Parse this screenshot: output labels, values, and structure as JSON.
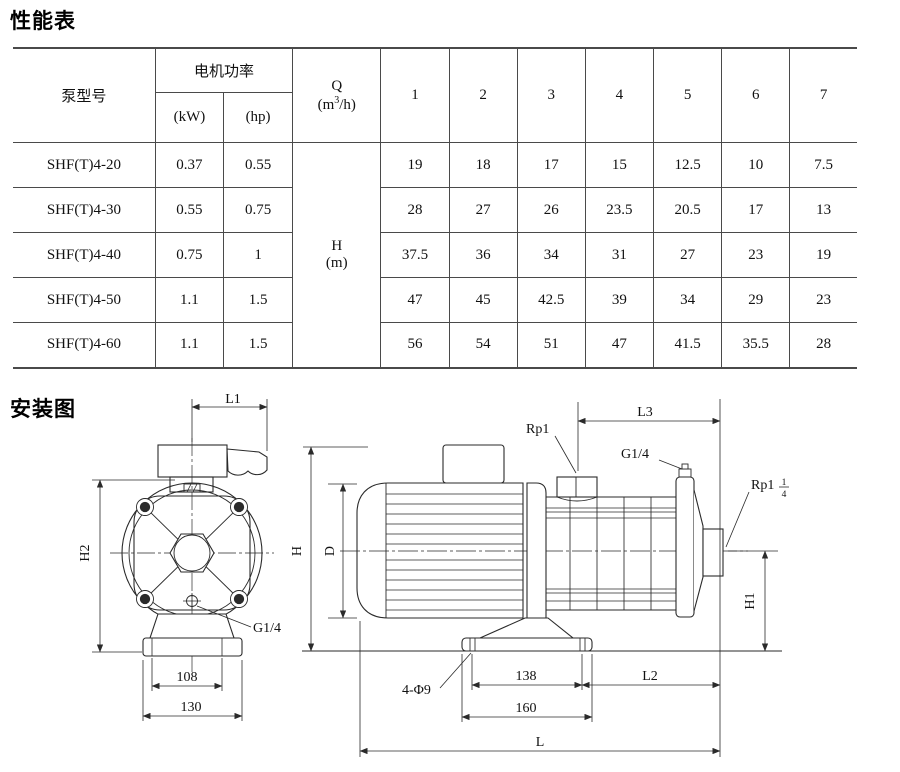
{
  "performance": {
    "title": "性能表",
    "table": {
      "col_model": "泵型号",
      "col_power": "电机功率",
      "col_kw": "(kW)",
      "col_hp": "(hp)",
      "q": {
        "sym": "Q",
        "pre": "(m",
        "sup": "3",
        "post": "/h)"
      },
      "h": {
        "sym": "H",
        "unit": "(m)"
      },
      "flow_cols": [
        "1",
        "2",
        "3",
        "4",
        "5",
        "6",
        "7"
      ],
      "rows": [
        {
          "model": "SHF(T)4-20",
          "kw": "0.37",
          "hp": "0.55",
          "heads": [
            "19",
            "18",
            "17",
            "15",
            "12.5",
            "10",
            "7.5"
          ]
        },
        {
          "model": "SHF(T)4-30",
          "kw": "0.55",
          "hp": "0.75",
          "heads": [
            "28",
            "27",
            "26",
            "23.5",
            "20.5",
            "17",
            "13"
          ]
        },
        {
          "model": "SHF(T)4-40",
          "kw": "0.75",
          "hp": "1",
          "heads": [
            "37.5",
            "36",
            "34",
            "31",
            "27",
            "23",
            "19"
          ]
        },
        {
          "model": "SHF(T)4-50",
          "kw": "1.1",
          "hp": "1.5",
          "heads": [
            "47",
            "45",
            "42.5",
            "39",
            "34",
            "29",
            "23"
          ]
        },
        {
          "model": "SHF(T)4-60",
          "kw": "1.1",
          "hp": "1.5",
          "heads": [
            "56",
            "54",
            "51",
            "47",
            "41.5",
            "35.5",
            "28"
          ]
        }
      ]
    }
  },
  "installation": {
    "title": "安装图",
    "front": {
      "l1": "L1",
      "h2": "H2",
      "g14": "G1/4",
      "d108": "108",
      "d130": "130"
    },
    "side": {
      "rp1": "Rp1",
      "l3": "L3",
      "g14": "G1/4",
      "rp114_main": "Rp1",
      "rp114_num": "1",
      "rp114_den": "4",
      "h": "H",
      "d": "D",
      "h1": "H1",
      "holes": "4-Φ9",
      "d138": "138",
      "d160": "160",
      "l2": "L2",
      "l": "L"
    }
  },
  "colors": {
    "line": "#2a2a2a",
    "table_border": "#4a4a4a"
  }
}
